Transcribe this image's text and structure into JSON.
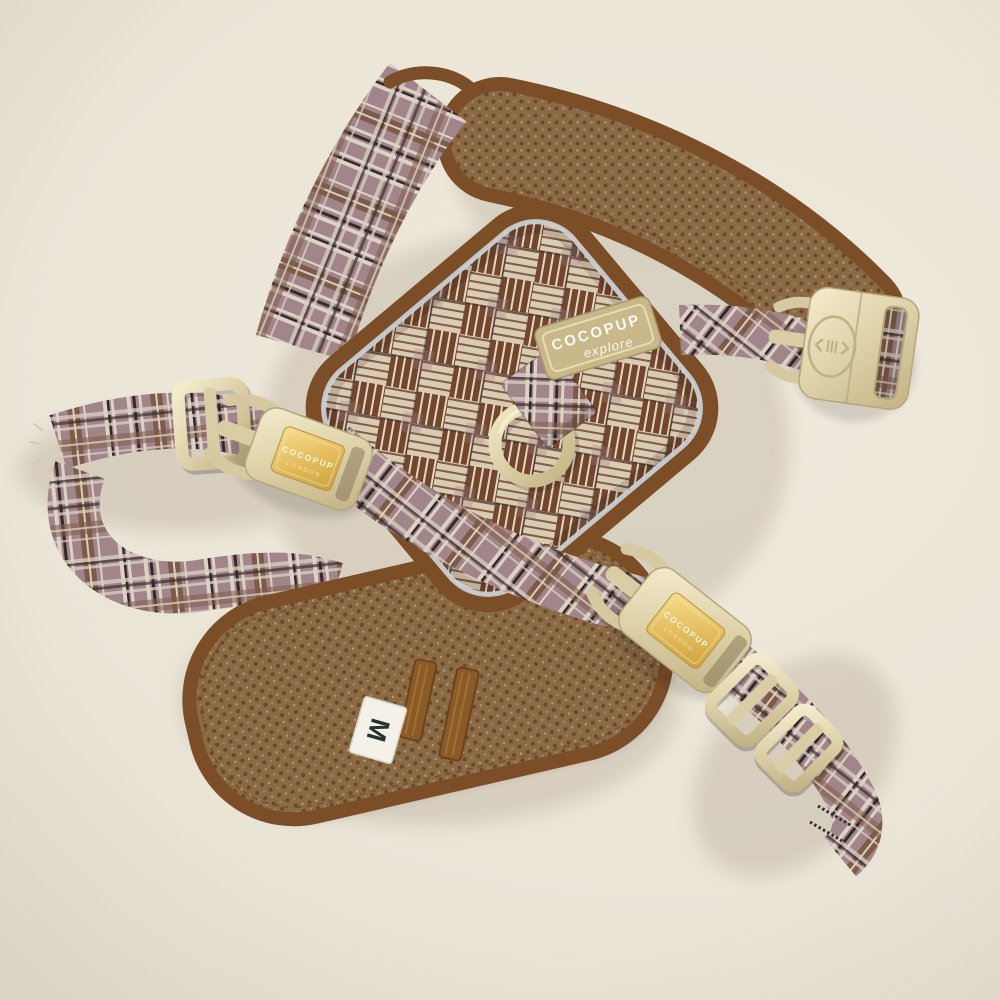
{
  "scene": {
    "description": "Flat-lay product photo of a brown glen-plaid dog harness with cream plastic buckles on a cream background",
    "background_color": "#ebe5d8"
  },
  "labels": {
    "back_badge": {
      "line1": "COCOPUP",
      "line2": "explore"
    },
    "left_buckle_plate": {
      "line1": "COCOPUP",
      "line2": "LONDON"
    },
    "bottom_buckle_plate": {
      "line1": "COCOPUP",
      "line2": "LONDON"
    },
    "size_tag": "M"
  },
  "colors": {
    "background": "#ebe5d8",
    "plaid_base": "#a1858a",
    "plaid_cream": "#ddd2c5",
    "plaid_dark": "#35282c",
    "plaid_brown": "#7e5a49",
    "glen_cream": "#d9ccb5",
    "glen_brown": "#74462e",
    "mesh_brown": "#8b6a45",
    "binding_brown": "#7b4e28",
    "buckle_cream": "#ded1a8",
    "gold_plate": "#e3bb5c",
    "reflective_piping": "#c9cdd0",
    "d_ring_cream": "#e0d4ab",
    "size_tag_bg": "#f4f1e8",
    "size_tag_text": "#25342c"
  }
}
